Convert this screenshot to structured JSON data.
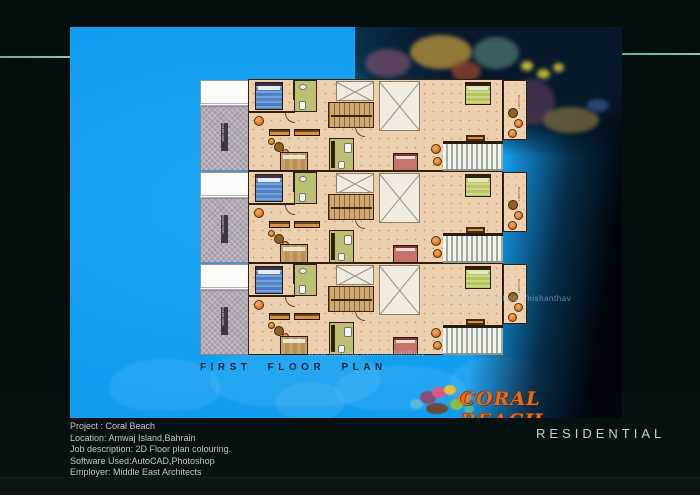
{
  "colors": {
    "frame_bg": "#050e0e",
    "teal_line": "#85b7b0",
    "water_blue": "#129ef0",
    "logo_orange": "#ee6a10",
    "plan_floor": "#eccfae"
  },
  "scene": {
    "plan_title": "FIRST FLOOR PLAN",
    "watermark_text": "www.coroflot.com/nishanthav",
    "logo_text": "CORAL BEACH"
  },
  "floor_plan": {
    "units": [
      {
        "name": "unit-1"
      },
      {
        "name": "unit-2"
      },
      {
        "name": "unit-3"
      }
    ],
    "court_label": "COURTYARD",
    "balcony_label": "BALCONY"
  },
  "footer": {
    "info_lines": [
      "Project : Coral Beach",
      "Location: Amwaj Island,Bahrain",
      "Job description: 2D Floor plan colouring.",
      "Software Used:AutoCAD,Photoshop",
      "Employer: Middle East Architects",
      "Year:2009"
    ],
    "category_label": "RESIDENTIAL"
  }
}
